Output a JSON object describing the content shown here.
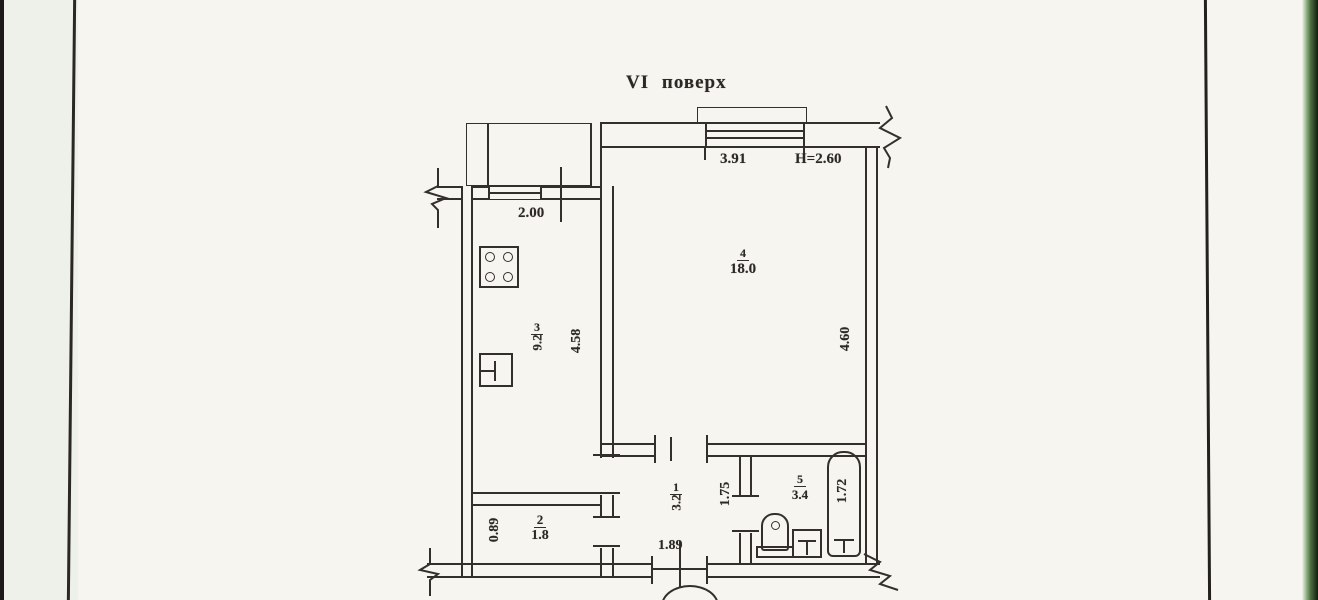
{
  "title": "VI поверх",
  "rooms": {
    "r1": {
      "number": "1",
      "area": "3.2"
    },
    "r2": {
      "number": "2",
      "area": "1.8"
    },
    "r3": {
      "number": "3",
      "area": "9.2"
    },
    "r4": {
      "number": "4",
      "area": "18.0"
    },
    "r5": {
      "number": "5",
      "area": "3.4"
    }
  },
  "dimensions": {
    "room4_width": "3.91",
    "ceiling_height": "Н=2.60",
    "balcony_width": "2.00",
    "kitchen_depth": "4.58",
    "room4_depth": "4.60",
    "room2_depth": "0.89",
    "hall_depth": "1.75",
    "bathtub_length": "1.72",
    "hall_width": "1.89"
  },
  "colors": {
    "ink": "#332f2c",
    "paper": "#f6f5f0",
    "scan_edge_green": "#4a6b42",
    "scan_edge_dark": "#101c0e"
  }
}
